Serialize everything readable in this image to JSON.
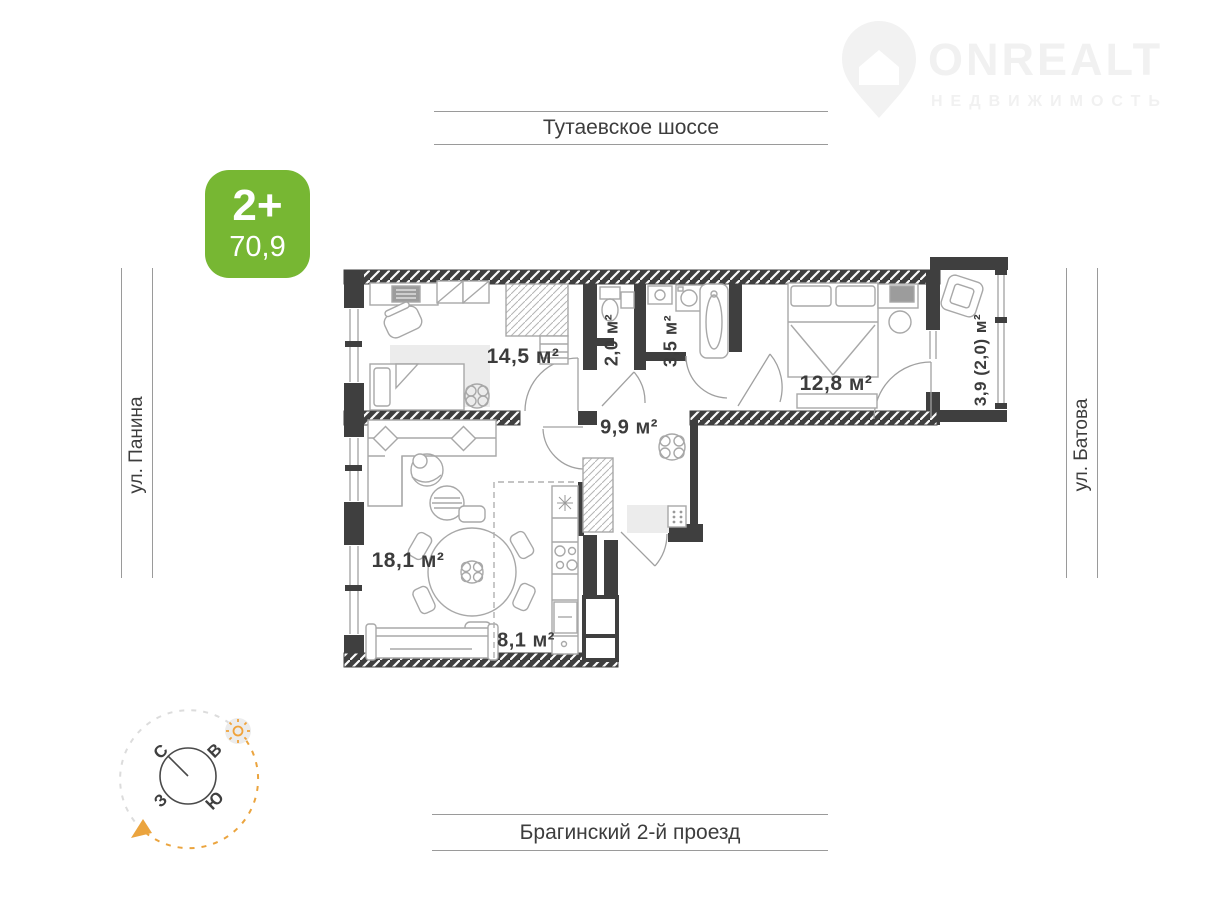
{
  "watermark": {
    "brand": "ONREALT",
    "subtitle": "НЕДВИЖИМОСТЬ"
  },
  "badge": {
    "rooms": "2+",
    "area": "70,9"
  },
  "streets": {
    "top": "Тутаевское шоссе",
    "bottom": "Брагинский 2-й проезд",
    "left": "ул. Панина",
    "right": "ул. Батова"
  },
  "rooms": {
    "r145": "14,5 м²",
    "r20": "2,0 м²",
    "r35": "3,5 м²",
    "r128": "12,8 м²",
    "balcony": "3,9 (2,0) м²",
    "hall": "9,9 м²",
    "living": "18,1 м²",
    "kitchen": "8,1 м²"
  },
  "compass": {
    "n": "С",
    "e": "В",
    "s": "Ю",
    "w": "З"
  },
  "colors": {
    "badge_green": "#77b733",
    "wall_dark": "#3f3f3f",
    "accent_orange": "#eba43e",
    "line_gray": "#9a9a9a",
    "text_dark": "#3d3d3d",
    "watermark_gray": "#f1f1f1"
  }
}
